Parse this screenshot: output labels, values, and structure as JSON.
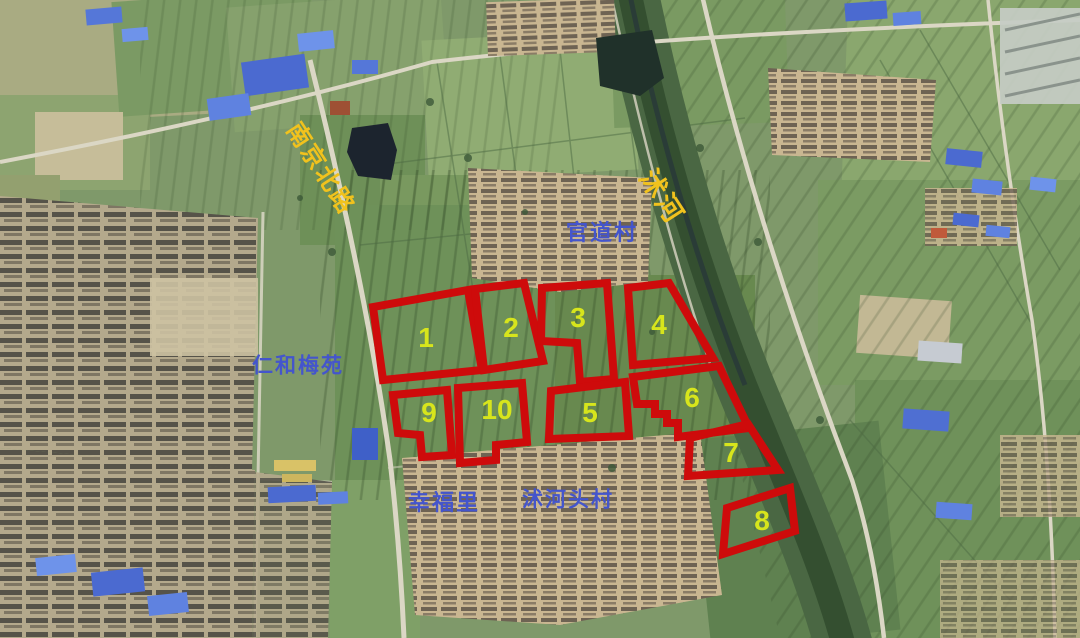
{
  "map_annotations": {
    "parcel_style": {
      "outline_color": "#ce0b0b",
      "outline_width": 8,
      "number_color": "#d7e51c",
      "number_font_size": 28
    },
    "parcels": [
      {
        "number": "1",
        "label_x": 426,
        "label_y": 347,
        "points": "373,307 468,290 482,370 383,380"
      },
      {
        "number": "2",
        "label_x": 511,
        "label_y": 337,
        "points": "475,289 524,283 543,361 484,370"
      },
      {
        "number": "3",
        "label_x": 578,
        "label_y": 327,
        "points": "542,288 607,283 614,379 580,382 577,343 541,341"
      },
      {
        "number": "4",
        "label_x": 659,
        "label_y": 334,
        "points": "628,288 669,283 713,358 633,365"
      },
      {
        "number": "5",
        "label_x": 590,
        "label_y": 422,
        "points": "551,391 625,382 629,436 549,439"
      },
      {
        "number": "6",
        "label_x": 692,
        "label_y": 407,
        "points": "633,377 719,366 749,428 678,437 678,423 667,423 667,414 655,414 655,404 637,404"
      },
      {
        "number": "7",
        "label_x": 731,
        "label_y": 462,
        "points": "690,438 748,424 778,470 688,476"
      },
      {
        "number": "8",
        "label_x": 762,
        "label_y": 530,
        "points": "727,508 790,488 795,531 723,554"
      },
      {
        "number": "9",
        "label_x": 429,
        "label_y": 422,
        "points": "393,395 447,390 452,455 422,457 420,435 398,433"
      },
      {
        "number": "10",
        "label_x": 497,
        "label_y": 419,
        "points": "458,388 522,383 527,442 496,445 496,460 460,463"
      }
    ],
    "labels": [
      {
        "text": "南京北路",
        "x": 320,
        "y": 169,
        "rotation": 57,
        "kind": "road",
        "color": "#f1c21d",
        "font_size": 24
      },
      {
        "text": "沭河",
        "x": 661,
        "y": 197,
        "rotation": 57,
        "kind": "river",
        "color": "#f1c21d",
        "font_size": 27
      },
      {
        "text": "官道村",
        "x": 602,
        "y": 233,
        "rotation": 0,
        "kind": "place",
        "color": "#4455cc",
        "font_size": 22
      },
      {
        "text": "仁和梅苑",
        "x": 298,
        "y": 366,
        "rotation": 0,
        "kind": "place",
        "color": "#4455cc",
        "font_size": 21
      },
      {
        "text": "幸福里",
        "x": 444,
        "y": 503,
        "rotation": 0,
        "kind": "place",
        "color": "#4455cc",
        "font_size": 22
      },
      {
        "text": "沭河头村",
        "x": 568,
        "y": 500,
        "rotation": 0,
        "kind": "place",
        "color": "#4455cc",
        "font_size": 21
      }
    ]
  }
}
